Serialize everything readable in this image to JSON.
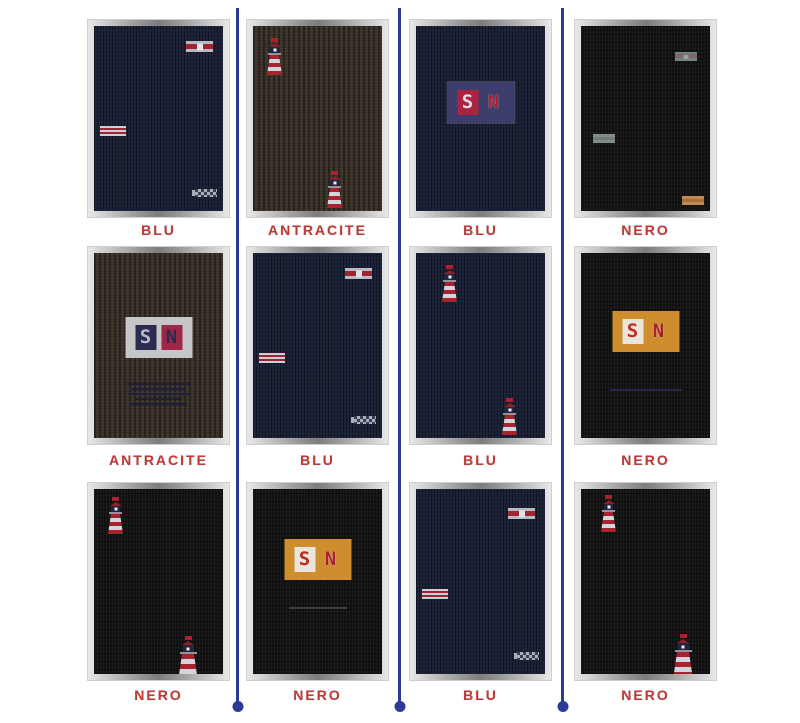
{
  "page": {
    "background_color": "#ffffff",
    "description": "Knit fabric colorway grid, 4 columns by 3 rows, separated by vertical blue rules ending in dots"
  },
  "brand": {
    "logo_letters": {
      "s": "S",
      "n": "N"
    }
  },
  "colors": {
    "divider": "#2b3a96",
    "label_text": "#c13b32",
    "frame_metal_light": "#e8e8e8",
    "frame_metal_dark": "#7d7d7d",
    "fabric": {
      "blu": "#1b2136",
      "antracite": "#3a3129",
      "nero": "#131313"
    },
    "motif_red": "#9e2531",
    "motif_white": "#d3d5da",
    "logo_patch_blu": "#3e3e6c",
    "logo_patch_silver": "#c6c6c9",
    "logo_patch_orange": "#cf8e2e"
  },
  "swatches": [
    {
      "position": "row1-col1",
      "label": "BLU",
      "fabric": "blu",
      "motifs": [
        "striped-flag-top-right",
        "striped-bar-mid-left",
        "checker-band-bottom-right"
      ]
    },
    {
      "position": "row1-col2",
      "label": "ANTRACITE",
      "fabric": "antracite",
      "motifs": [
        "lighthouse-top-left",
        "lighthouse-bottom-right"
      ]
    },
    {
      "position": "row1-col3",
      "label": "BLU",
      "fabric": "blu",
      "motifs": [
        "sn-logo-center"
      ]
    },
    {
      "position": "row1-col4",
      "label": "NERO",
      "fabric": "nero",
      "motifs": [
        "muted-flag-top-right",
        "muted-bar-mid-left",
        "orange-bar-bottom-right"
      ]
    },
    {
      "position": "row2-col1",
      "label": "ANTRACITE",
      "fabric": "antracite",
      "motifs": [
        "sn-logo-center",
        "woven-text-lines-below"
      ]
    },
    {
      "position": "row2-col2",
      "label": "BLU",
      "fabric": "blu",
      "motifs": [
        "striped-flag-top-right",
        "striped-bar-mid-left",
        "checker-band-bottom-right"
      ]
    },
    {
      "position": "row2-col3",
      "label": "BLU",
      "fabric": "blu",
      "motifs": [
        "lighthouse-top-left",
        "lighthouse-bottom-right"
      ]
    },
    {
      "position": "row2-col4",
      "label": "NERO",
      "fabric": "nero",
      "motifs": [
        "sn-logo-center",
        "navy-underline-below"
      ]
    },
    {
      "position": "row3-col1",
      "label": "NERO",
      "fabric": "nero",
      "motifs": [
        "lighthouse-top-left",
        "lighthouse-bottom-right"
      ]
    },
    {
      "position": "row3-col2",
      "label": "NERO",
      "fabric": "nero",
      "motifs": [
        "sn-logo-center",
        "gray-underline-below"
      ]
    },
    {
      "position": "row3-col3",
      "label": "BLU",
      "fabric": "blu",
      "motifs": [
        "striped-flag-top-right",
        "striped-bar-mid-left",
        "checker-band-bottom-right"
      ]
    },
    {
      "position": "row3-col4",
      "label": "NERO",
      "fabric": "nero",
      "motifs": [
        "lighthouse-top-left",
        "lighthouse-bottom-right"
      ]
    }
  ]
}
